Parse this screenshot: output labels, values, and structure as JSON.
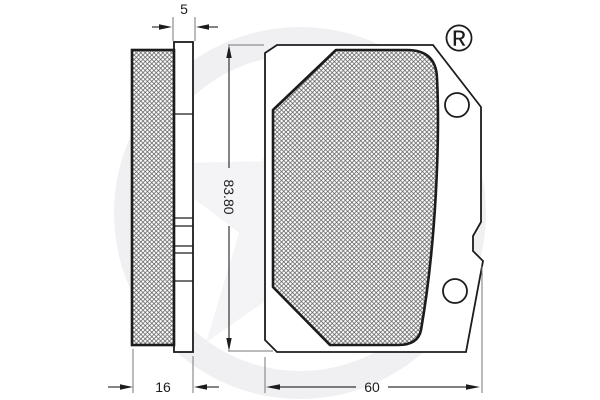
{
  "drawing": {
    "title": "brake-pad-technical-drawing",
    "dimensions": {
      "plate_thickness": "5",
      "pad_height": "83.80",
      "total_thickness": "16",
      "pad_width": "60"
    },
    "watermark": {
      "registered_symbol": "®"
    },
    "colors": {
      "line": "#1c1c1c",
      "dimension_line": "#555555",
      "hatch": "#5a5a5a",
      "watermark": "#f1f1f3",
      "watermark_symbol": "#d9d9db",
      "background": "#ffffff"
    }
  }
}
